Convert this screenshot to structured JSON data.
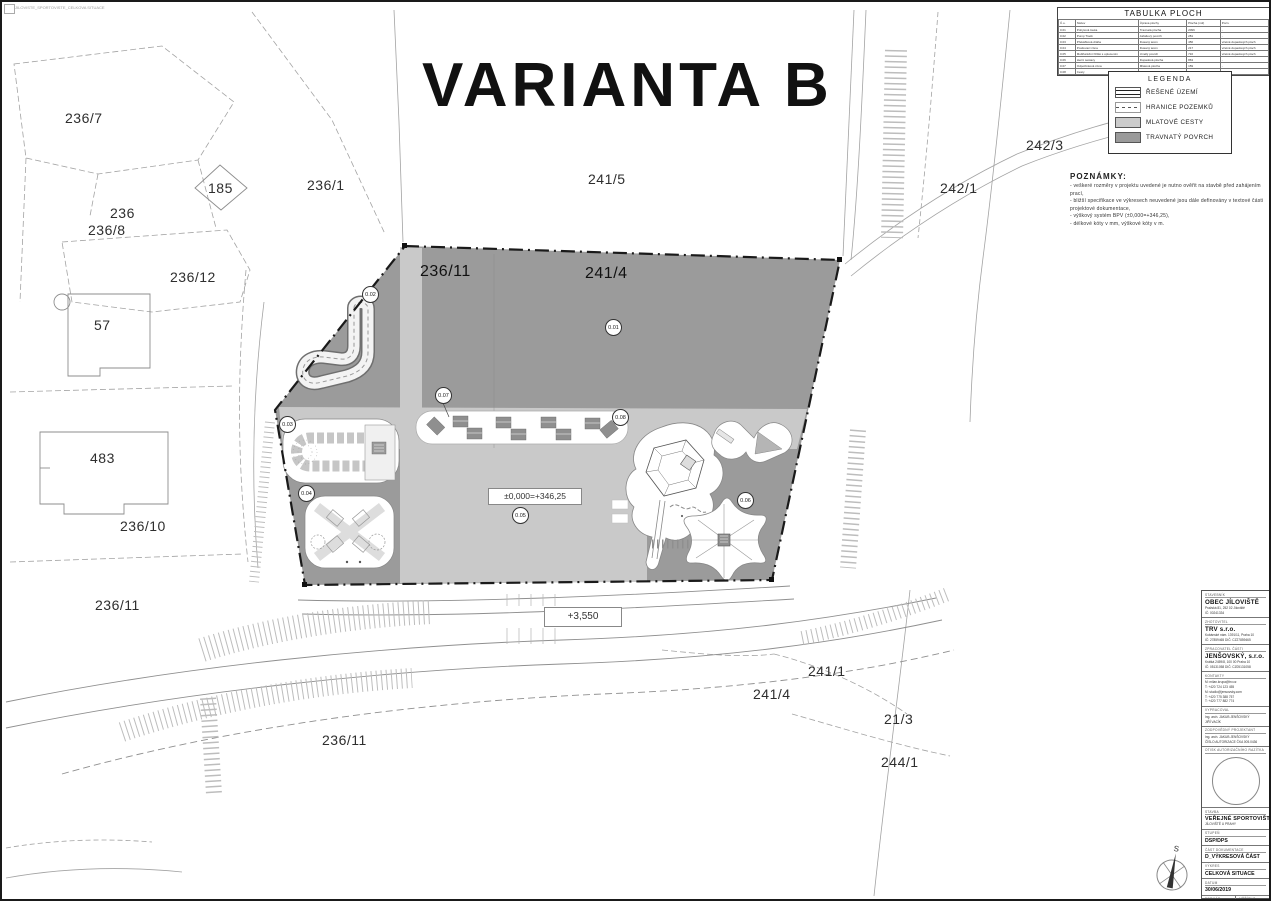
{
  "sheet": {
    "title": "VARIANTA B",
    "plot_stamp": "JILOVISTE_SPORTOVISTE_CELKOVA SITUACE"
  },
  "tabulka": {
    "title": "TABULKA PLOCH",
    "headers": [
      "Č.o.",
      "Název",
      "Úprava plochy",
      "Plocha (m2)",
      "Pozn."
    ],
    "rows": [
      [
        "0.01",
        "Pobytová louka",
        "Travnatá plocha",
        "2096",
        "-"
      ],
      [
        "0.02",
        "Pump Track",
        "Asfaltový povrch",
        "281",
        "-"
      ],
      [
        "0.03",
        "Překážková dráha",
        "Dusaný terén",
        "456",
        "včetně dopadových ploch"
      ],
      [
        "0.04",
        "Posilovací zóna",
        "Dusaný terén",
        "217",
        "včetně dopadových ploch"
      ],
      [
        "0.05",
        "Multifunkční hřiště s oplocením",
        "Umělý povrch",
        "716",
        "včetně dopadových ploch"
      ],
      [
        "0.06",
        "Herní sestavy",
        "Dopadová plocha",
        "863",
        "-"
      ],
      [
        "0.07",
        "Odpočinková zóna",
        "Mlatová plocha",
        "159",
        "-"
      ],
      [
        "0.08",
        "Cesty",
        "Mlatová plocha",
        "882",
        "-"
      ]
    ]
  },
  "legend": {
    "title": "LEGENDA",
    "items": [
      {
        "type": "resene",
        "label": "ŘEŠENÉ ÚZEMÍ"
      },
      {
        "type": "hranice",
        "label": "HRANICE POZEMKŮ"
      },
      {
        "type": "mlat",
        "label": "MLATOVÉ CESTY"
      },
      {
        "type": "trava",
        "label": "TRAVNATÝ POVRCH"
      }
    ]
  },
  "notes": {
    "title": "POZNÁMKY:",
    "lines": [
      "- veškeré rozměry v projektu uvedené je nutno ověřit na stavbě před zahájením prací,",
      "- bližší specifikace ve výkresech neuvedené jsou dále definovány v textové části projektové dokumentace,",
      "- výškový systém BPV (±0,000=+346,25),",
      "- délkové kóty v mm, výškové kóty v m."
    ]
  },
  "plan": {
    "areas": [
      "0.01",
      "0.02",
      "0.03",
      "0.04",
      "0.05",
      "0.06",
      "0.07",
      "0.08"
    ],
    "level_label": "±0,000=+346,25",
    "height_label": "+3,550",
    "parcels": [
      "236/7",
      "185",
      "236",
      "236/1",
      "236/8",
      "236/12",
      "57",
      "241/5",
      "236/11",
      "241/4",
      "483",
      "236/10",
      "236/11",
      "236/11",
      "242/3",
      "242/1",
      "241/1",
      "241/4",
      "21/3",
      "244/1"
    ]
  },
  "north": {
    "letter": "S"
  },
  "titleblock": {
    "stavebnik": {
      "label": "STAVEBNÍK",
      "name": "OBEC JÍLOVIŠTĚ",
      "line1": "Pražská 81, 252 02 Jíloviště",
      "line2": "IČ: 00241334"
    },
    "zhotovitel": {
      "label": "ZHOTOVITEL",
      "name": "TRV s.r.o.",
      "line1": "Kubánské nám. 1391/11, Praha 10",
      "line2": "IČ: 27859465    DIČ: CZ27859465"
    },
    "zpracovatel": {
      "label": "ZPRACOVATEL ČÁSTI",
      "name": "JENŠOVSKÝ, s.r.o.",
      "line1": "Krátká 2459/8, 100 00 Praha 10",
      "line2": "IČ: 05131058    DIČ: CZ05131058"
    },
    "kontakty": {
      "label": "KONTAKTY",
      "lines": [
        "M: milan.krupa@trv.cz",
        "T: +420 724 123 455",
        "M: studio@jensovsky.com",
        "T: +420 775 388 757",
        "T: +420 777 882 774"
      ]
    },
    "vypracoval": {
      "label": "VYPRACOVAL",
      "line1": "Ing. arch. JAKUB JENŠOVSKÝ",
      "line2": "JIŘÍ VACÍK"
    },
    "zodpovedny": {
      "label": "ZODPOVĚDNÝ PROJEKTANT",
      "line1": "Ing. arch. JAKUB JENŠOVSKÝ",
      "line2": "ČÍSLO AUTORIZACE ČKA 005.0436"
    },
    "razitko": {
      "label": "OTISK AUTORIZAČNÍHO RAZÍTKA"
    },
    "stavba": {
      "label": "STAVBA",
      "name": "VEŘEJNÉ SPORTOVIŠTĚ",
      "line2": "JÍLOVIŠTĚ U PRAHY"
    },
    "stupen": {
      "label": "STUPEŇ",
      "value": "DSP/DPS"
    },
    "cast": {
      "label": "ČÁST DOKUMENTACE",
      "value": "D_VÝKRESOVÁ ČÁST"
    },
    "vykres": {
      "label": "VÝKRES",
      "value": "CELKOVÁ SITUACE"
    },
    "datum": {
      "label": "DATUM",
      "value": "30/06/2019"
    },
    "format": {
      "label": "FORMÁT",
      "value": "A0 (841×1189)"
    },
    "meritko": {
      "label": "MĚŘÍTKO",
      "value": "1:250"
    },
    "cislo": {
      "label": "ČÍSLO VÝKRESU",
      "value": "001"
    },
    "pare": {
      "label": "PARÉ",
      "value": ""
    }
  }
}
